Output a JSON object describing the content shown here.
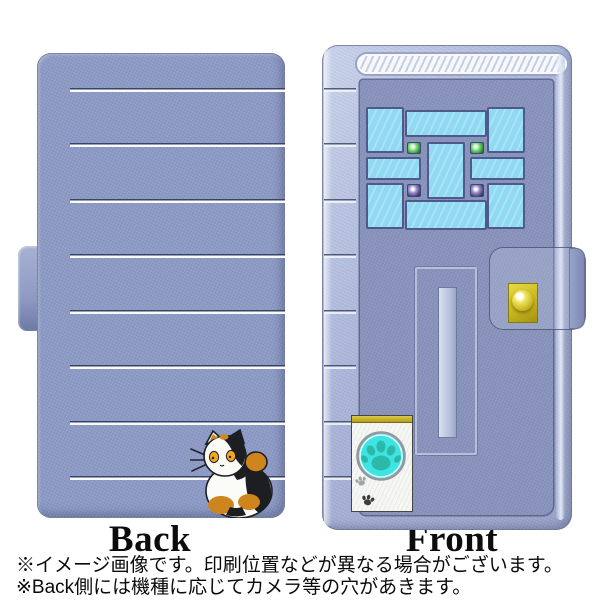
{
  "canvas": {
    "background": "#FFFFFF"
  },
  "views": {
    "back": {
      "label": "Back"
    },
    "front": {
      "label": "Front"
    }
  },
  "notes": {
    "line1": "※イメージ画像です。印刷位置などが異なる場合がございます。",
    "line2": "※Back側には機種に応じてカメラ等の穴があきます。"
  },
  "icons": {
    "paw_button": "paw-print-icon",
    "small_paw_steps": "paw-steps-icon",
    "doorknob": "doorknob-icon",
    "cat": "calico-cat-illustration"
  },
  "colors": {
    "case_periwinkle": "#8C9AC5",
    "door_face": "#8893BC",
    "frame_light": "#AFBADB",
    "stripe_dark": "#32405F",
    "stripe_white": "#FFFFFF",
    "window_pane_blue": "#90D9F2",
    "window_border": "#4E5A89",
    "glass_light_green": "#2E8C30",
    "glass_light_purple": "#453C78",
    "doorknob_gold": "#D6C42B",
    "paw_button_cyan": "#3EE4E4",
    "paw_teal": "#2CB9AA",
    "cat_orange": "#CE851D",
    "cat_black": "#1C1E22",
    "text": "#0A0A0A"
  }
}
